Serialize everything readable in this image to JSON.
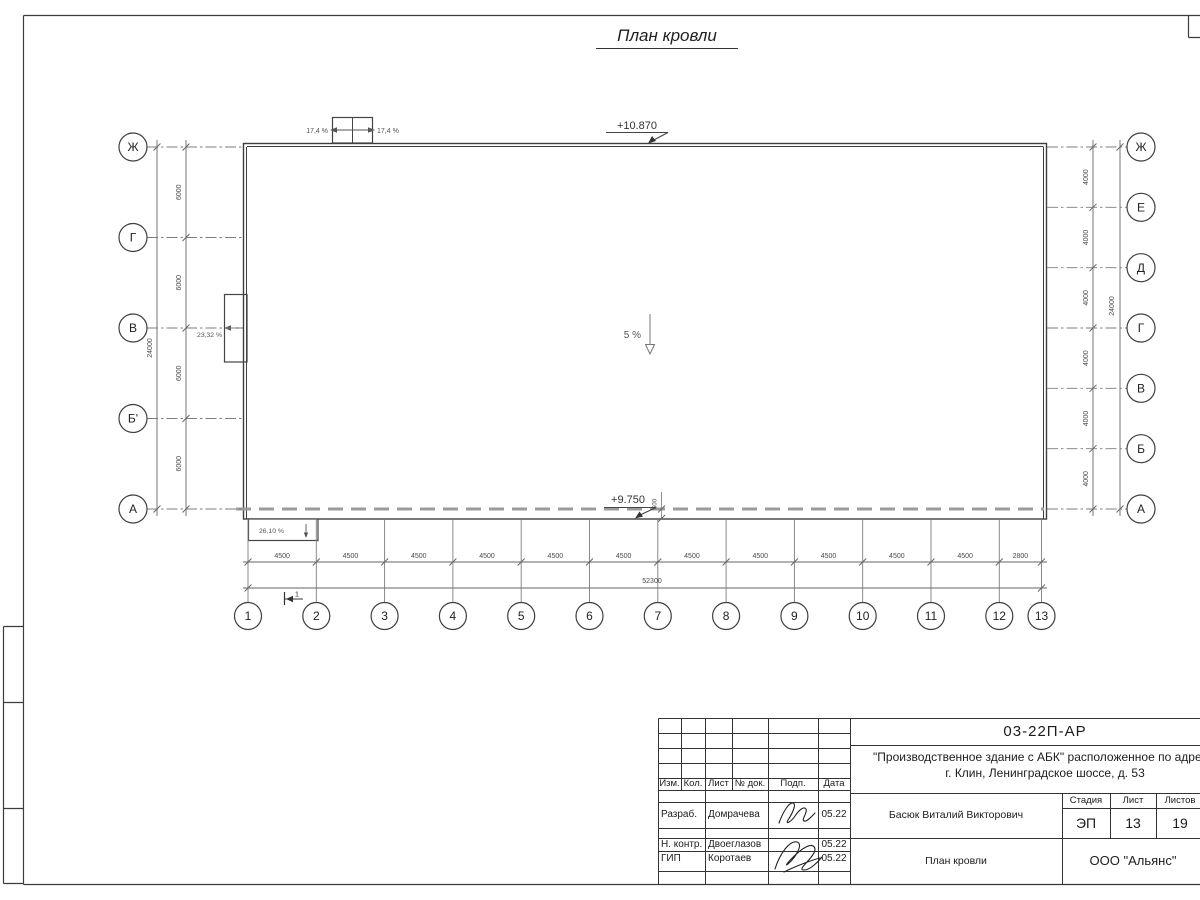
{
  "sheet": {
    "title": "План кровли"
  },
  "plan": {
    "elevation_top": "+10.870",
    "elevation_bottom": "+9.750",
    "main_slope": "5 %",
    "skylight_slope_left": "17,4 %",
    "skylight_slope_right": "17,4 %",
    "west_canopy_slope": "23,32 %",
    "south_canopy_slope": "26,10 %",
    "parapet_offset_dim": "600",
    "detail_mark": "1",
    "axes": {
      "left": {
        "labels": [
          "Ж",
          "Г",
          "В",
          "Б'",
          "А"
        ],
        "spacing_labels": [
          "6000",
          "6000",
          "6000",
          "6000"
        ],
        "total_label": "24000"
      },
      "right": {
        "labels": [
          "Ж",
          "Е",
          "Д",
          "Г",
          "В",
          "Б",
          "А"
        ],
        "spacing_labels": [
          "4000",
          "4000",
          "4000",
          "4000",
          "4000",
          "4000"
        ],
        "total_label": "24000"
      },
      "bottom": {
        "labels": [
          "1",
          "2",
          "3",
          "4",
          "5",
          "6",
          "7",
          "8",
          "9",
          "10",
          "11",
          "12",
          "13"
        ],
        "spacing_labels": [
          "4500",
          "4500",
          "4500",
          "4500",
          "4500",
          "4500",
          "4500",
          "4500",
          "4500",
          "4500",
          "4500",
          "2800"
        ],
        "total_label": "52300"
      }
    }
  },
  "title_block": {
    "doc_number": "03-22П-АР",
    "project_line1": "\"Производственное здание с АБК\" расположенное по адресу:",
    "project_line2": "г. Клин, Ленинградское шоссе, д. 53",
    "header_cols": [
      "Изм.",
      "Кол.",
      "Лист",
      "№ док.",
      "Подп.",
      "Дата"
    ],
    "rows": [
      {
        "role": "Разраб.",
        "name": "Домрачева",
        "date": "05.22"
      },
      {
        "role": "Н. контр.",
        "name": "Двоеглазов",
        "date": "05.22"
      },
      {
        "role": "ГИП",
        "name": "Коротаев",
        "date": "05.22"
      }
    ],
    "approver": "Басюк Виталий Викторович",
    "stage_label": "Стадия",
    "stage": "ЭП",
    "sheet_label": "Лист",
    "sheet": "13",
    "sheets_label": "Листов",
    "sheets": "19",
    "drawing_name": "План кровли",
    "company": "ООО \"Альянс\""
  }
}
